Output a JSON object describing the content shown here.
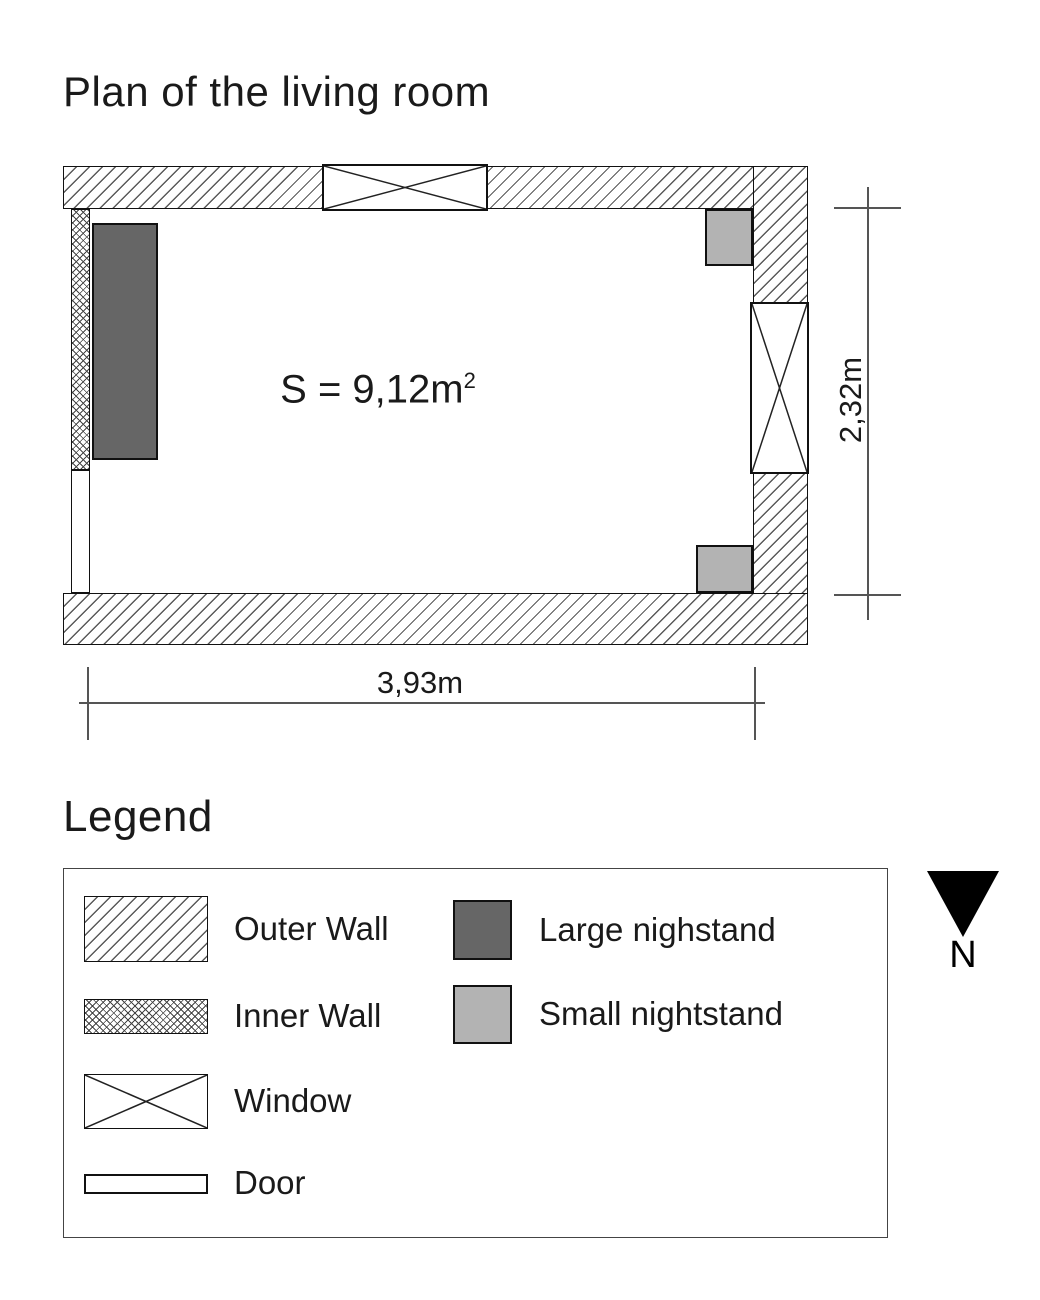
{
  "title": "Plan of the living room",
  "plan": {
    "area_value": "S = 9,12m",
    "area_sup": "2",
    "width_label": "3,93m",
    "height_label": "2,32m"
  },
  "legend": {
    "heading": "Legend",
    "items": [
      {
        "id": "outer-wall",
        "label": "Outer Wall"
      },
      {
        "id": "inner-wall",
        "label": "Inner Wall"
      },
      {
        "id": "window",
        "label": "Window"
      },
      {
        "id": "door",
        "label": "Door"
      },
      {
        "id": "large-nightstand",
        "label": "Large nighstand"
      },
      {
        "id": "small-nightstand",
        "label": "Small nightstand"
      }
    ]
  },
  "compass": {
    "label": "N"
  },
  "colors": {
    "large_nightstand_fill": "#666666",
    "small_nightstand_fill": "#b3b3b3",
    "hatch_line": "#5a5a5a",
    "outline": "#111111"
  }
}
